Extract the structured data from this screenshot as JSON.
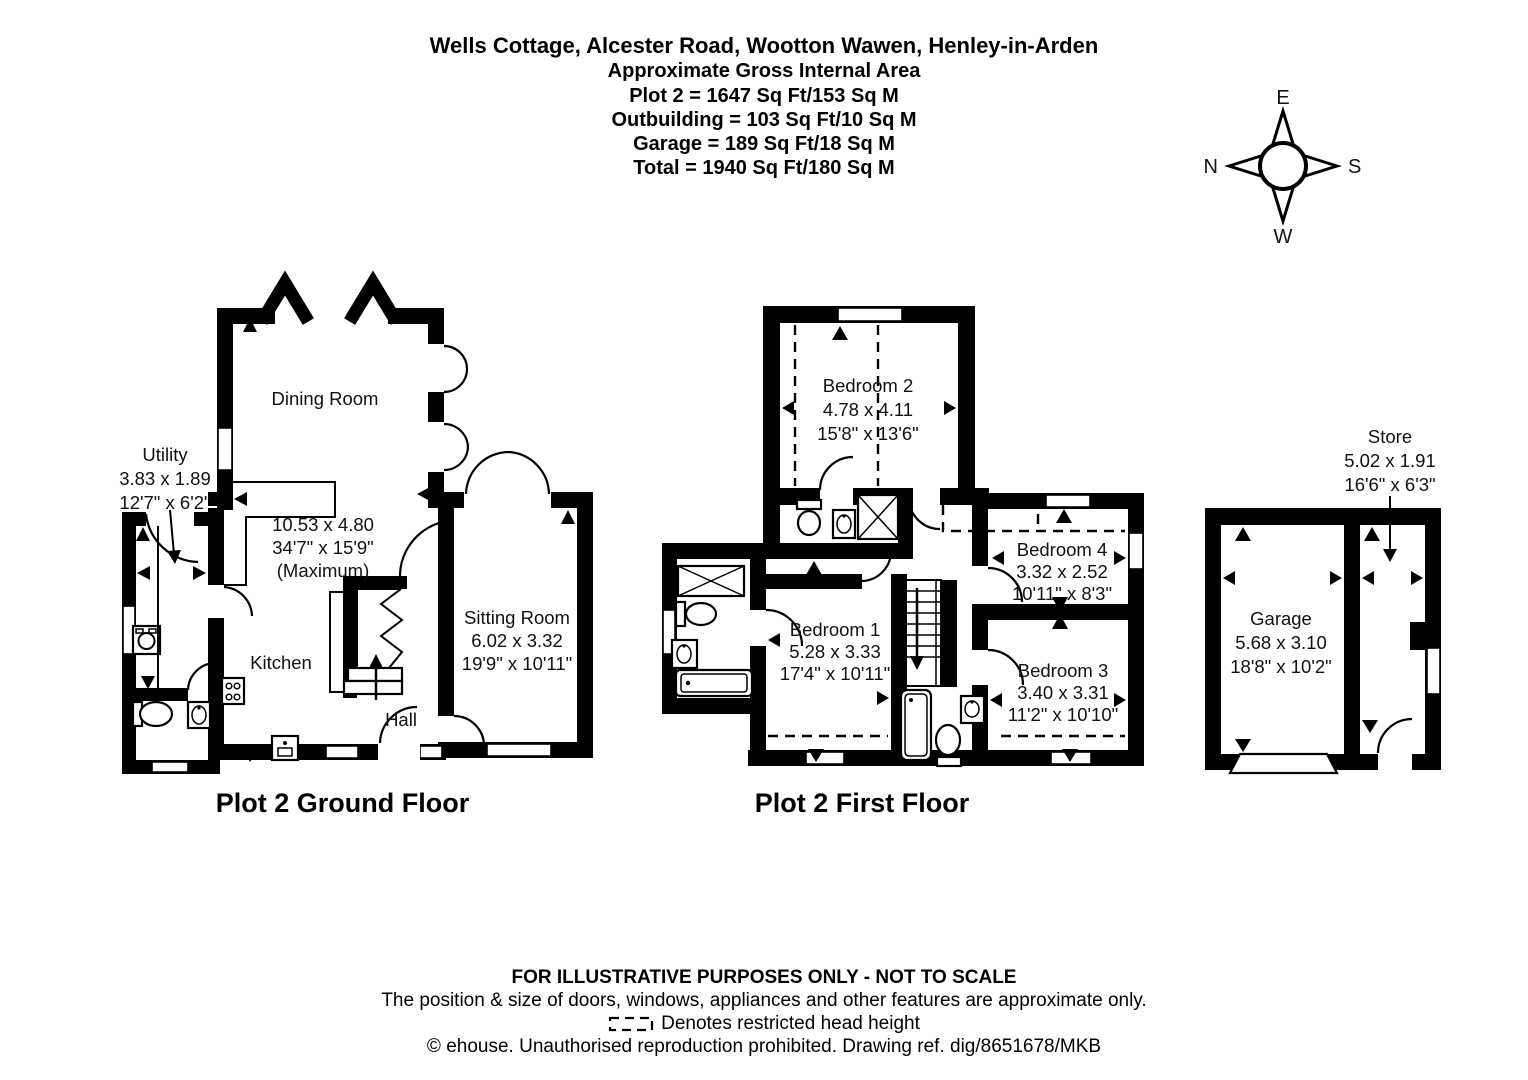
{
  "title": {
    "address": "Wells Cottage, Alcester Road, Wootton Wawen, Henley-in-Arden",
    "subtitle": "Approximate Gross Internal Area",
    "areas": [
      "Plot 2 = 1647 Sq Ft/153 Sq M",
      "Outbuilding = 103 Sq Ft/10 Sq M",
      "Garage = 189 Sq Ft/18 Sq M",
      "Total = 1940 Sq Ft/180 Sq M"
    ]
  },
  "compass": {
    "top": "E",
    "right": "S",
    "bottom": "W",
    "left": "N"
  },
  "ground_floor": {
    "label": "Plot 2 Ground Floor",
    "rooms": {
      "dining_room": {
        "name": "Dining Room"
      },
      "utility": {
        "name": "Utility",
        "metric": "3.83 x 1.89",
        "imperial": "12'7\" x 6'2\""
      },
      "kitchen_dining_overall": {
        "metric": "10.53 x 4.80",
        "imperial": "34'7\" x 15'9\"",
        "note": "(Maximum)"
      },
      "kitchen": {
        "name": "Kitchen"
      },
      "hall": {
        "name": "Hall"
      },
      "sitting_room": {
        "name": "Sitting Room",
        "metric": "6.02 x 3.32",
        "imperial": "19'9\" x 10'11\""
      }
    }
  },
  "first_floor": {
    "label": "Plot 2 First Floor",
    "rooms": {
      "bedroom_1": {
        "name": "Bedroom 1",
        "metric": "5.28 x 3.33",
        "imperial": "17'4\" x 10'11\""
      },
      "bedroom_2": {
        "name": "Bedroom 2",
        "metric": "4.78 x 4.11",
        "imperial": "15'8\" x 13'6\""
      },
      "bedroom_3": {
        "name": "Bedroom 3",
        "metric": "3.40 x 3.31",
        "imperial": "11'2\" x 10'10\""
      },
      "bedroom_4": {
        "name": "Bedroom 4",
        "metric": "3.32 x 2.52",
        "imperial": "10'11\" x 8'3\""
      }
    }
  },
  "outbuilding": {
    "rooms": {
      "store": {
        "name": "Store",
        "metric": "5.02 x 1.91",
        "imperial": "16'6\" x 6'3\""
      },
      "garage": {
        "name": "Garage",
        "metric": "5.68 x 3.10",
        "imperial": "18'8\" x 10'2\""
      }
    }
  },
  "footer": {
    "line1": "FOR ILLUSTRATIVE PURPOSES ONLY - NOT TO SCALE",
    "line2": "The position & size of doors, windows, appliances and other features are approximate only.",
    "legend": "Denotes restricted head height",
    "line3": "© ehouse. Unauthorised reproduction prohibited. Drawing ref. dig/8651678/MKB"
  }
}
